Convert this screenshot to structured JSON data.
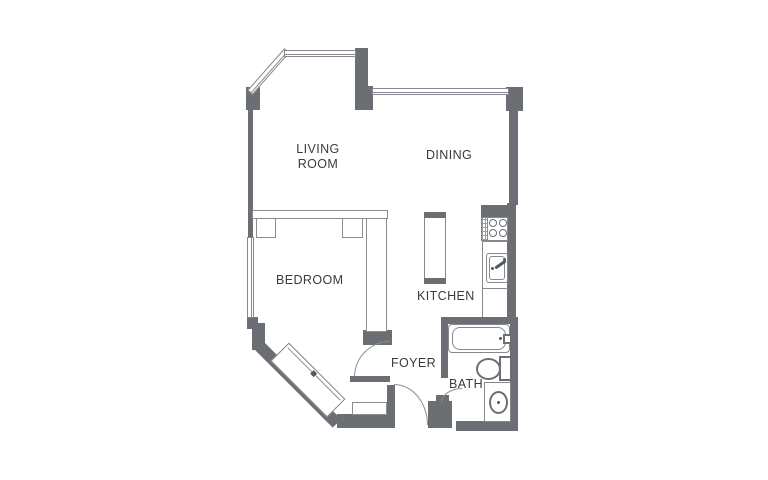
{
  "colors": {
    "wall": "#6b6f73",
    "thin_line": "#8a8d91",
    "text": "#3b3b3b",
    "background": "#ffffff"
  },
  "rooms": {
    "living": {
      "label": "LIVING ROOM"
    },
    "dining": {
      "label": "DINING"
    },
    "bedroom": {
      "label": "BEDROOM"
    },
    "kitchen": {
      "label": "KITCHEN"
    },
    "foyer": {
      "label": "FOYER"
    },
    "bath": {
      "label": "BATH"
    }
  },
  "fixtures": {
    "bathtub": "bathtub",
    "toilet": "toilet",
    "bathroom_sink": "vanity with oval sink",
    "kitchen_sink": "kitchen sink with faucet",
    "stove": "stove with 4 burners",
    "island": "kitchen island counter",
    "closet": "angled sliding-door closet",
    "windows": "windows (triple-line)",
    "doors": "swing doors with arcs"
  }
}
